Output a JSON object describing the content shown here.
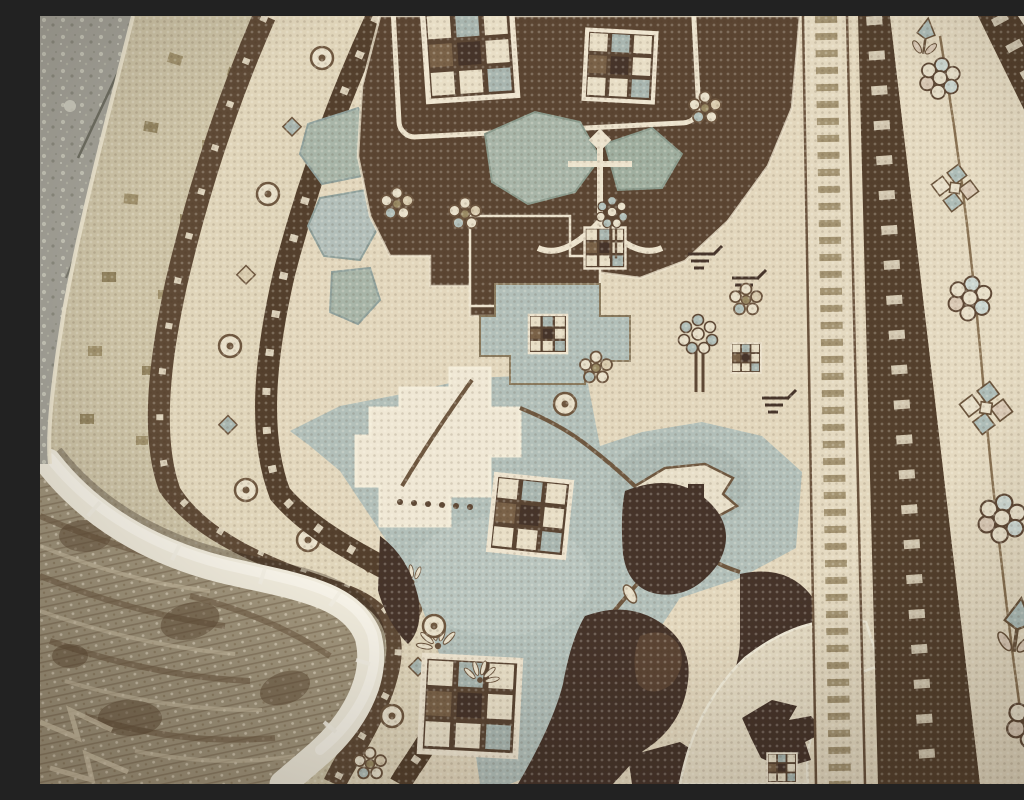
{
  "scene": {
    "type": "photograph",
    "description": "Close-up photograph of a vintage hand-knotted Persian carpet with its corner folded over, lying on a weathered gray stone floor",
    "objects": {
      "floor": "weathered speckled gray-green stone floor visible at the top-left and top-right corners, with thin dark cracks",
      "rug_face": "carpet pile face with a dark chocolate-brown medallion area, ivory ground and pale slate-blue field filled with geometric flowers, checkered blocks, vines and leaf motifs",
      "rug_back": "washed-out khaki underside of the folded corner at the bottom-left, pattern showing through faintly in weave rows",
      "selvage": "thick fluffy off-white bound edge curling along the fold from the left edge around to the bottom",
      "folded_border": "sun-faded outer border bands sweeping in an S-curve around the folded corner: faded ivory guard, brown band, ivory floral band with rosettes, brown trefoil guard",
      "right_border": "diagonal border system on the right: boteh guard stripe, dark trefoil guard, wide ivory main border with rosette clusters, pinwheels and tulips, outer trefoil guard and narrow ivory edge"
    }
  },
  "palette": {
    "floor_gray": "#a5a399",
    "floor_gray2": "#9aa092",
    "floor_speckle": "#cbcabc",
    "crack_gray": "#6f6e62",
    "ivory_field": "#e3d7bd",
    "ivory_light": "#efe7d4",
    "faded_border": "#cdc3a6",
    "band_brown": "#5f4a36",
    "guard_brown": "#54402d",
    "floral_band": "#e0d5ba",
    "medallion_brown": "#5b4532",
    "dark_motif": "#46342a",
    "slate_blue": "#b2bfb9",
    "slate_blue_light": "#c0cbc5",
    "gray_green": "#a8b5a8",
    "olive": "#9a8a64",
    "vine_brown": "#6f5840",
    "trefoil_cream": "#e9dfc8",
    "outline_cream": "#ece2cc",
    "boteh_ground": "#e4d9c0",
    "main_border_ivory": "#e5dac1",
    "ivory_leaf": "#e6dcc4",
    "back_khaki": "#a1957c",
    "back_streak": "#6e5a42",
    "selvage_white": "#efeadb"
  },
  "regions": [
    {
      "name": "floor-top-left",
      "label": "stone floor"
    },
    {
      "name": "floor-top-right",
      "label": "stone floor corner"
    },
    {
      "name": "folded-corner",
      "label": "folded rug corner with curved border bands"
    },
    {
      "name": "medallion",
      "label": "brown medallion with cream lattice and gray-green leaves"
    },
    {
      "name": "blue-field",
      "label": "pale slate-blue field with flowers and checker blocks"
    },
    {
      "name": "right-border",
      "label": "multi-band rug border"
    },
    {
      "name": "selvage",
      "label": "white fringe edge"
    },
    {
      "name": "rug-back",
      "label": "underside of folded corner"
    }
  ]
}
